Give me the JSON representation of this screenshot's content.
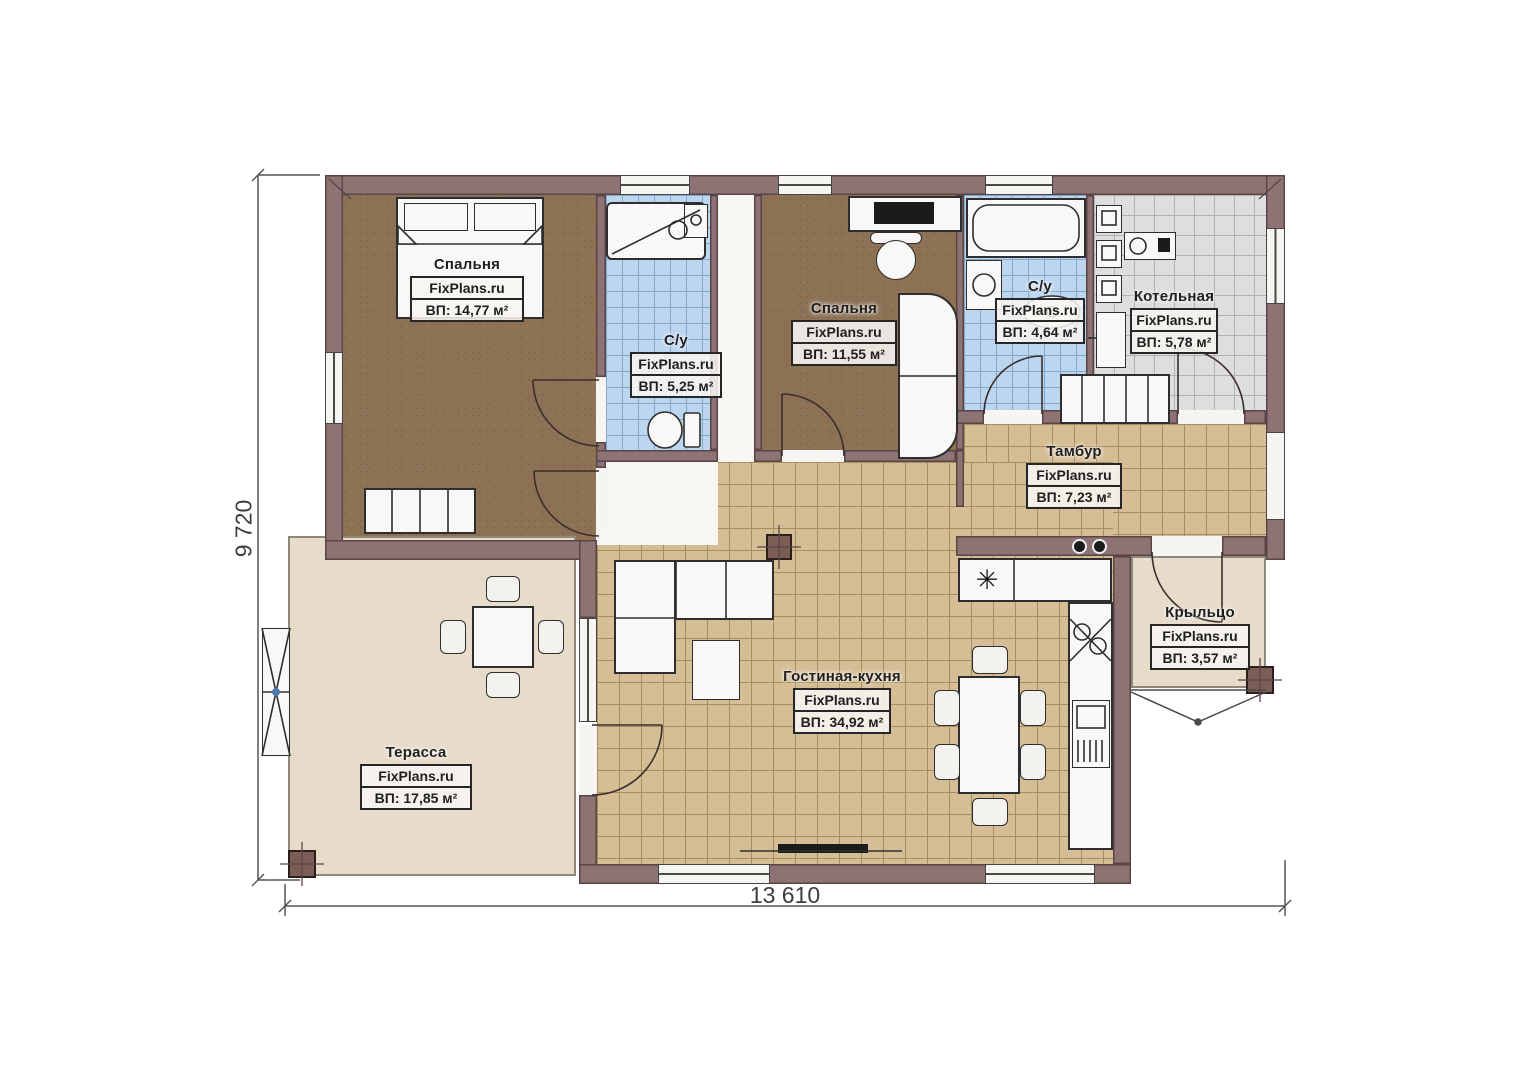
{
  "dimensions": {
    "bottom": "13 610",
    "left": "9 720"
  },
  "rooms": [
    {
      "key": "bedroom-1",
      "name": "Спальня",
      "brand": "FixPlans.ru",
      "area": "ВП: 14,77 м²"
    },
    {
      "key": "bathroom-1",
      "name": "С/у",
      "brand": "FixPlans.ru",
      "area": "ВП: 5,25 м²"
    },
    {
      "key": "bedroom-2",
      "name": "Спальня",
      "brand": "FixPlans.ru",
      "area": "ВП: 11,55 м²"
    },
    {
      "key": "bathroom-2",
      "name": "С/у",
      "brand": "FixPlans.ru",
      "area": "ВП: 4,64 м²"
    },
    {
      "key": "boiler-room",
      "name": "Котельная",
      "brand": "FixPlans.ru",
      "area": "ВП: 5,78 м²"
    },
    {
      "key": "vestibule",
      "name": "Тамбур",
      "brand": "FixPlans.ru",
      "area": "ВП: 7,23 м²"
    },
    {
      "key": "porch",
      "name": "Крыльцо",
      "brand": "FixPlans.ru",
      "area": "ВП: 3,57 м²"
    },
    {
      "key": "living-kitchen",
      "name": "Гостиная-кухня",
      "brand": "FixPlans.ru",
      "area": "ВП: 34,92 м²"
    },
    {
      "key": "terrace",
      "name": "Терасса",
      "brand": "FixPlans.ru",
      "area": "ВП: 17,85 м²"
    }
  ],
  "icons": {
    "fridge": "✳"
  },
  "colors": {
    "wall": "#8d7373",
    "wall_outline": "#5a4546",
    "tile_blue": "#bcd6ef",
    "tile_gray": "#dedede",
    "tile_sand": "#d5be95",
    "floor_wood": "#8c7155",
    "terrace": "#e7dbc9",
    "label_border": "#262626"
  }
}
